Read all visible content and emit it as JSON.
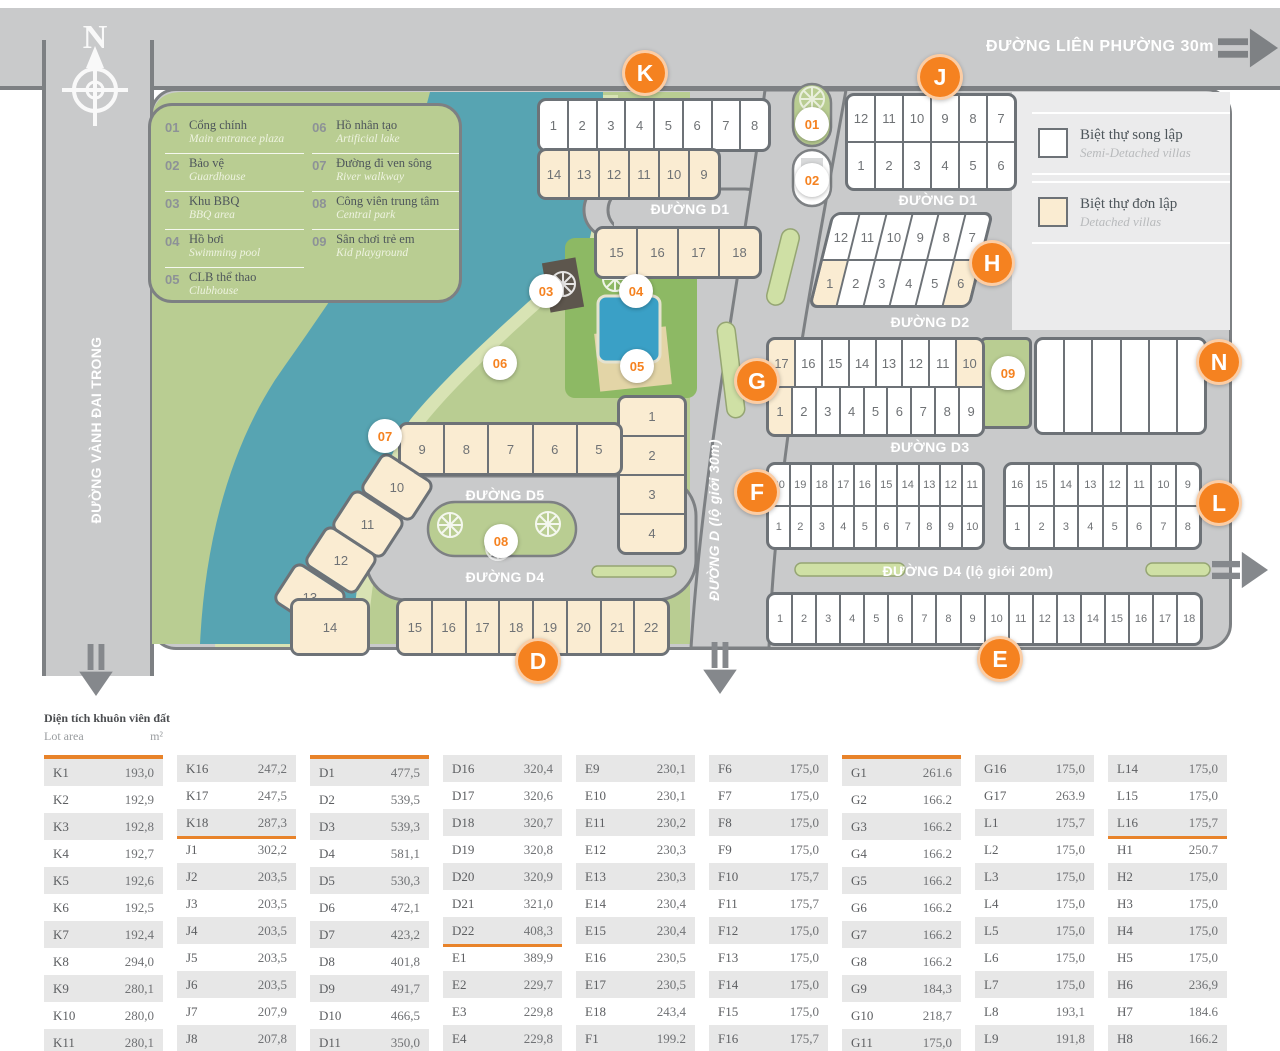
{
  "map": {
    "compass_label": "N",
    "roads": {
      "lien_phuong": "ĐƯỜNG LIÊN PHƯỜNG 30m",
      "vanh_dai_trong": "ĐƯỜNG VÀNH ĐAI TRONG",
      "d1": "ĐƯỜNG D1",
      "d2": "ĐƯỜNG D2",
      "d3": "ĐƯỜNG D3",
      "d4_main": "ĐƯỜNG D4 (lộ giới 20m)",
      "d4_small": "ĐƯỜNG D4",
      "d5": "ĐƯỜNG D5",
      "d_vertical": "ĐƯỜNG D (lộ giới 30m)"
    },
    "letter_markers": [
      "K",
      "J",
      "H",
      "G",
      "N",
      "F",
      "L",
      "D",
      "E"
    ],
    "num_markers": [
      "01",
      "02",
      "03",
      "04",
      "05",
      "06",
      "07",
      "08",
      "09"
    ],
    "legend_items": [
      {
        "num": "01",
        "vi": "Cổng chính",
        "en": "Main entrance plaza"
      },
      {
        "num": "02",
        "vi": "Bảo vệ",
        "en": "Guardhouse"
      },
      {
        "num": "03",
        "vi": "Khu BBQ",
        "en": "BBQ area"
      },
      {
        "num": "04",
        "vi": "Hồ bơi",
        "en": "Swimming pool"
      },
      {
        "num": "05",
        "vi": "CLB thể thao",
        "en": "Clubhouse"
      },
      {
        "num": "06",
        "vi": "Hồ nhân tạo",
        "en": "Artificial lake"
      },
      {
        "num": "07",
        "vi": "Đường đi ven sông",
        "en": "River walkway"
      },
      {
        "num": "08",
        "vi": "Công viên trung tâm",
        "en": "Central park"
      },
      {
        "num": "09",
        "vi": "Sân chơi trẻ em",
        "en": "Kid playground"
      }
    ],
    "villa_types": [
      {
        "vi": "Biệt thự song lập",
        "en": "Semi-Detached villas",
        "swatch": "#ffffff"
      },
      {
        "vi": "Biệt thự đơn lập",
        "en": "Detached villas",
        "swatch": "#faecd2"
      }
    ],
    "blocks": {
      "k_top": {
        "default": "semi",
        "rows": [
          [
            "1",
            "2",
            "3",
            "4",
            "5",
            "6",
            "7",
            "8"
          ]
        ]
      },
      "k_mid": {
        "default": "det",
        "rows": [
          [
            "14",
            "13",
            "12",
            "11",
            "10",
            "9"
          ]
        ]
      },
      "k_low": {
        "default": "det",
        "rows": [
          [
            "15",
            "16",
            "17",
            "18"
          ]
        ]
      },
      "j": {
        "default": "semi",
        "rows": [
          [
            "12",
            "11",
            "10",
            "9",
            "8",
            "7"
          ],
          [
            "1",
            "2",
            "3",
            "4",
            "5",
            "6"
          ]
        ]
      },
      "h": {
        "default": "semi",
        "rows": [
          [
            "12",
            "11",
            "10",
            "9",
            "8",
            "7"
          ],
          [
            {
              "n": "1",
              "t": "det"
            },
            "2",
            "3",
            "4",
            "5",
            {
              "n": "6",
              "t": "det"
            }
          ]
        ]
      },
      "g": {
        "default": "semi",
        "rows": [
          [
            {
              "n": "17",
              "t": "det"
            },
            "16",
            "15",
            "14",
            "13",
            "12",
            "11",
            {
              "n": "10",
              "t": "det"
            }
          ],
          [
            {
              "n": "1",
              "t": "det"
            },
            "2",
            "3",
            "4",
            "5",
            "6",
            "7",
            "8",
            "9"
          ]
        ]
      },
      "n_block": {
        "default": "semi",
        "rows": [
          [
            "",
            "",
            "",
            "",
            "",
            ""
          ]
        ]
      },
      "f": {
        "default": "semi",
        "rows": [
          [
            "20",
            "19",
            "18",
            "17",
            "16",
            "15",
            "14",
            "13",
            "12",
            "11"
          ],
          [
            "1",
            "2",
            "3",
            "4",
            "5",
            "6",
            "7",
            "8",
            "9",
            "10"
          ]
        ]
      },
      "l": {
        "default": "semi",
        "rows": [
          [
            "16",
            "15",
            "14",
            "13",
            "12",
            "11",
            "10",
            "9"
          ],
          [
            "1",
            "2",
            "3",
            "4",
            "5",
            "6",
            "7",
            "8"
          ]
        ]
      },
      "e": {
        "default": "semi",
        "rows": [
          [
            "1",
            "2",
            "3",
            "4",
            "5",
            "6",
            "7",
            "8",
            "9",
            "10",
            "11",
            "12",
            "13",
            "14",
            "15",
            "16",
            "17",
            "18"
          ]
        ]
      },
      "d_col": {
        "default": "det",
        "rows": [
          [
            "1"
          ],
          [
            "2"
          ],
          [
            "3"
          ],
          [
            "4"
          ]
        ]
      },
      "d_up": {
        "default": "det",
        "rows": [
          [
            "9",
            "8",
            "7",
            "6",
            "5"
          ]
        ]
      },
      "d10": {
        "default": "det",
        "rows": [
          [
            "10"
          ]
        ]
      },
      "d11": {
        "default": "det",
        "rows": [
          [
            "11"
          ]
        ]
      },
      "d12": {
        "default": "det",
        "rows": [
          [
            "12"
          ]
        ]
      },
      "d13": {
        "default": "det",
        "rows": [
          [
            "13"
          ]
        ]
      },
      "d14": {
        "default": "det",
        "rows": [
          [
            "14"
          ]
        ]
      },
      "d_bot": {
        "default": "det",
        "rows": [
          [
            "15",
            "16",
            "17",
            "18",
            "19",
            "20",
            "21",
            "22"
          ]
        ]
      }
    }
  },
  "table": {
    "title_vi": "Diện tích khuôn viên đất",
    "title_en": "Lot area",
    "unit": "m²",
    "columns": [
      [
        {
          "l": "K1",
          "v": "193,0"
        },
        {
          "l": "K2",
          "v": "192,9"
        },
        {
          "l": "K3",
          "v": "192,8"
        },
        {
          "l": "K4",
          "v": "192,7"
        },
        {
          "l": "K5",
          "v": "192,6"
        },
        {
          "l": "K6",
          "v": "192,5"
        },
        {
          "l": "K7",
          "v": "192,4"
        },
        {
          "l": "K8",
          "v": "294,0"
        },
        {
          "l": "K9",
          "v": "280,1"
        },
        {
          "l": "K10",
          "v": "280,0"
        },
        {
          "l": "K11",
          "v": "280,1"
        }
      ],
      [
        {
          "l": "K16",
          "v": "247,2"
        },
        {
          "l": "K17",
          "v": "247,5"
        },
        {
          "l": "K18",
          "v": "287,3",
          "r": 1
        },
        {
          "l": "J1",
          "v": "302,2"
        },
        {
          "l": "J2",
          "v": "203,5"
        },
        {
          "l": "J3",
          "v": "203,5"
        },
        {
          "l": "J4",
          "v": "203,5"
        },
        {
          "l": "J5",
          "v": "203,5"
        },
        {
          "l": "J6",
          "v": "203,5"
        },
        {
          "l": "J7",
          "v": "207,9"
        },
        {
          "l": "J8",
          "v": "207,8"
        }
      ],
      [
        {
          "l": "D1",
          "v": "477,5"
        },
        {
          "l": "D2",
          "v": "539,5"
        },
        {
          "l": "D3",
          "v": "539,3"
        },
        {
          "l": "D4",
          "v": "581,1"
        },
        {
          "l": "D5",
          "v": "530,3"
        },
        {
          "l": "D6",
          "v": "472,1"
        },
        {
          "l": "D7",
          "v": "423,2"
        },
        {
          "l": "D8",
          "v": "401,8"
        },
        {
          "l": "D9",
          "v": "491,7"
        },
        {
          "l": "D10",
          "v": "466,5"
        },
        {
          "l": "D11",
          "v": "350,0"
        }
      ],
      [
        {
          "l": "D16",
          "v": "320,4"
        },
        {
          "l": "D17",
          "v": "320,6"
        },
        {
          "l": "D18",
          "v": "320,7"
        },
        {
          "l": "D19",
          "v": "320,8"
        },
        {
          "l": "D20",
          "v": "320,9"
        },
        {
          "l": "D21",
          "v": "321,0"
        },
        {
          "l": "D22",
          "v": "408,3",
          "r": 1
        },
        {
          "l": "E1",
          "v": "389,9"
        },
        {
          "l": "E2",
          "v": "229,7"
        },
        {
          "l": "E3",
          "v": "229,8"
        },
        {
          "l": "E4",
          "v": "229,8"
        }
      ],
      [
        {
          "l": "E9",
          "v": "230,1"
        },
        {
          "l": "E10",
          "v": "230,1"
        },
        {
          "l": "E11",
          "v": "230,2"
        },
        {
          "l": "E12",
          "v": "230,3"
        },
        {
          "l": "E13",
          "v": "230,3"
        },
        {
          "l": "E14",
          "v": "230,4"
        },
        {
          "l": "E15",
          "v": "230,4"
        },
        {
          "l": "E16",
          "v": "230,5"
        },
        {
          "l": "E17",
          "v": "230,5"
        },
        {
          "l": "E18",
          "v": "243,4",
          "r": 1
        },
        {
          "l": "F1",
          "v": "199.2"
        }
      ],
      [
        {
          "l": "F6",
          "v": "175,0"
        },
        {
          "l": "F7",
          "v": "175,0"
        },
        {
          "l": "F8",
          "v": "175,0"
        },
        {
          "l": "F9",
          "v": "175,0"
        },
        {
          "l": "F10",
          "v": "175,7"
        },
        {
          "l": "F11",
          "v": "175,7"
        },
        {
          "l": "F12",
          "v": "175,0"
        },
        {
          "l": "F13",
          "v": "175,0"
        },
        {
          "l": "F14",
          "v": "175,0"
        },
        {
          "l": "F15",
          "v": "175,0"
        },
        {
          "l": "F16",
          "v": "175,7"
        }
      ],
      [
        {
          "l": "G1",
          "v": "261.6"
        },
        {
          "l": "G2",
          "v": "166.2"
        },
        {
          "l": "G3",
          "v": "166.2"
        },
        {
          "l": "G4",
          "v": "166.2"
        },
        {
          "l": "G5",
          "v": "166.2"
        },
        {
          "l": "G6",
          "v": "166.2"
        },
        {
          "l": "G7",
          "v": "166.2"
        },
        {
          "l": "G8",
          "v": "166.2"
        },
        {
          "l": "G9",
          "v": "184,3"
        },
        {
          "l": "G10",
          "v": "218,7"
        },
        {
          "l": "G11",
          "v": "175,0"
        }
      ],
      [
        {
          "l": "G16",
          "v": "175,0"
        },
        {
          "l": "G17",
          "v": "263.9",
          "r": 1
        },
        {
          "l": "L1",
          "v": "175,7"
        },
        {
          "l": "L2",
          "v": "175,0"
        },
        {
          "l": "L3",
          "v": "175,0"
        },
        {
          "l": "L4",
          "v": "175,0"
        },
        {
          "l": "L5",
          "v": "175,0"
        },
        {
          "l": "L6",
          "v": "175,0"
        },
        {
          "l": "L7",
          "v": "175,0"
        },
        {
          "l": "L8",
          "v": "193,1"
        },
        {
          "l": "L9",
          "v": "191,8"
        }
      ],
      [
        {
          "l": "L14",
          "v": "175,0"
        },
        {
          "l": "L15",
          "v": "175,0"
        },
        {
          "l": "L16",
          "v": "175,7",
          "r": 1
        },
        {
          "l": "H1",
          "v": "250.7"
        },
        {
          "l": "H2",
          "v": "175,0"
        },
        {
          "l": "H3",
          "v": "175,0"
        },
        {
          "l": "H4",
          "v": "175,0"
        },
        {
          "l": "H5",
          "v": "175,0"
        },
        {
          "l": "H6",
          "v": "236,9"
        },
        {
          "l": "H7",
          "v": "184.6"
        },
        {
          "l": "H8",
          "v": "166.2"
        }
      ]
    ]
  },
  "colors": {
    "road": "#c9cacb",
    "road_border": "#7d8083",
    "park_green": "#b9cd92",
    "lake": "#57a4b2",
    "walkway": "#d8e3b4",
    "lot_semi": "#ffffff",
    "lot_detached": "#faecd2",
    "lot_border": "#6d7277",
    "accent_orange": "#f58220",
    "table_rule_orange": "#e8832a",
    "panel_light": "#ebebec",
    "table_stripe": "#e7e7e7"
  }
}
